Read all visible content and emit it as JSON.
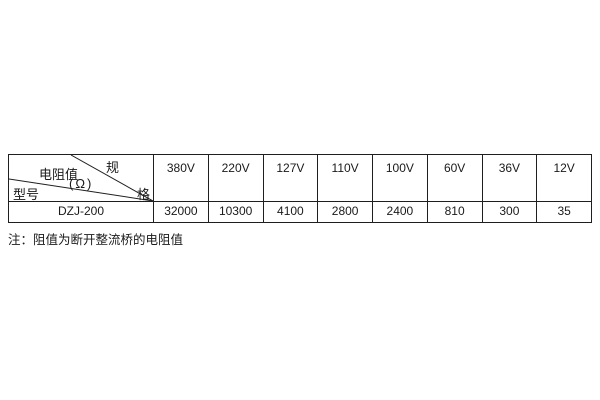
{
  "page": {
    "background": "#ffffff",
    "line_color": "#1f1f1f"
  },
  "table": {
    "corner": {
      "spec_top": "规",
      "spec_bottom": "格",
      "resistance_label": "电阻值",
      "resistance_unit": "(Ω)",
      "model_label": "型号"
    },
    "voltage_columns": [
      "380V",
      "220V",
      "127V",
      "110V",
      "100V",
      "60V",
      "36V",
      "12V"
    ],
    "rows": [
      {
        "model": "DZJ-200",
        "values": [
          "32000",
          "10300",
          "4100",
          "2800",
          "2400",
          "810",
          "300",
          "35"
        ]
      }
    ]
  },
  "note": "注：阻值为断开整流桥的电阻值"
}
